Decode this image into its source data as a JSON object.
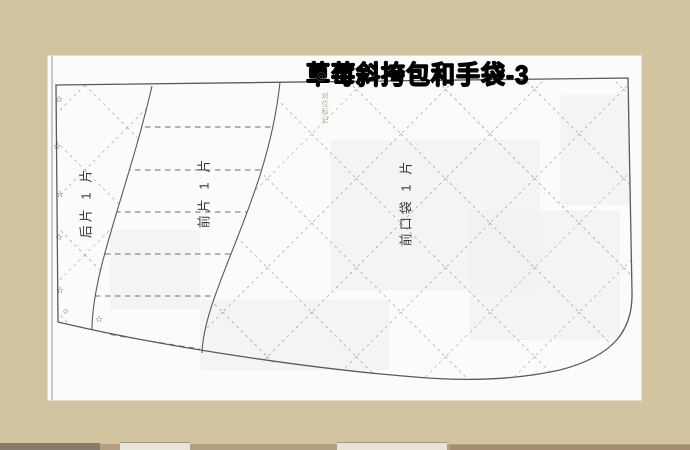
{
  "title": {
    "text": "草莓斜挎包和手袋-3"
  },
  "pieces": {
    "back": {
      "label": "后片 1 片"
    },
    "front": {
      "label": "前片 1 片"
    },
    "pocket": {
      "label": "前口袋 1 片"
    }
  },
  "marks": {
    "star": "☆",
    "small_circle": "○",
    "snap": "◎",
    "watermark": "对位标记"
  },
  "colors": {
    "desk": "#d3c4a1",
    "page": "#fbfbfa",
    "outline": "#5a5a5a",
    "dash": "#828282",
    "bottom_band": "#b3a083"
  }
}
